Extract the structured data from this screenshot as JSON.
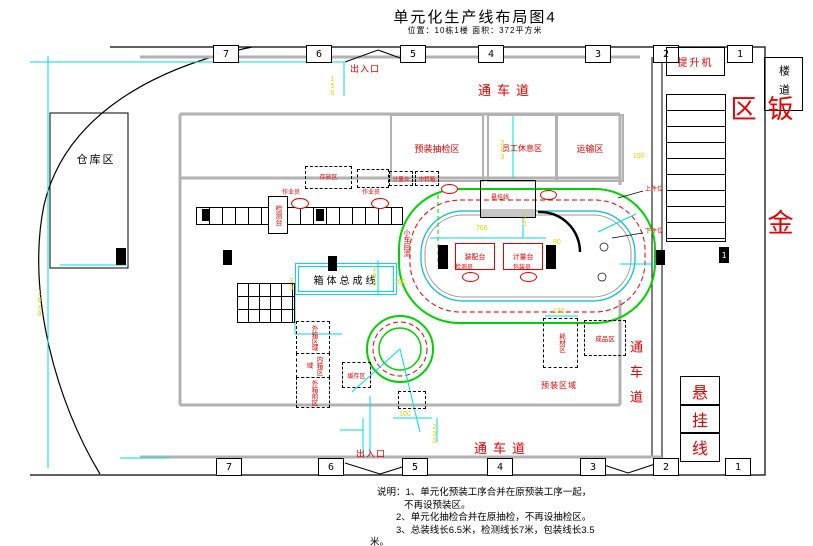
{
  "title": {
    "main": "单元化生产线布局图4",
    "subtitle": "位置：10栋1楼  面积：372平方米"
  },
  "grid": {
    "top": [
      "7",
      "6",
      "5",
      "4",
      "3",
      "2",
      "1"
    ],
    "bottom": [
      "7",
      "6",
      "5",
      "4",
      "3",
      "2",
      "1"
    ]
  },
  "corridors": {
    "top": "通车道",
    "bottom": "通车道",
    "right": "通车道"
  },
  "entrances": {
    "top": "出入口",
    "bottom": "出入口"
  },
  "zones": {
    "warehouse": "仓库区",
    "lift": "提升机",
    "stairwell": "楼道",
    "sheet_metal": "钣金区",
    "hanging": {
      "c0": "悬",
      "c1": "挂",
      "c2": "线"
    },
    "preassembly_inspection": "预装抽检区",
    "staff_rest": "员工休息区",
    "transport": "运输区",
    "preassembly_area": "预装区域",
    "outer_carton": "外箱区域",
    "inner_carton": "内箱区域",
    "outer_carton_front": "外箱前区",
    "buffer": "缓存区",
    "consumables": "耗材区",
    "finished_goods": "成品区",
    "box_assembly_line": "箱体总成线"
  },
  "stations": {
    "assembly": "装配台",
    "metering": "计量台",
    "test": "检测台",
    "storage": "存放区",
    "metering_small": "计量台",
    "transfer_box": "中转箱",
    "machine_label": "悬挂线",
    "load": "上件位",
    "unload": "下件位",
    "trolley_return": "小车回流",
    "column_label": "1"
  },
  "people": {
    "operator_a": "作业员",
    "operator_b": "作业员",
    "inspector": "检测员",
    "packer": "包装员"
  },
  "dims": [
    "766",
    "50",
    "80",
    "150",
    "150",
    "130",
    "186",
    "100",
    "30",
    "100",
    "230",
    "18x9",
    "283"
  ],
  "notes": [
    "说明：1、单元化预装工序合并在原预装工序一起，",
    "不再设预装区。",
    "2、单元化抽检合并在原抽检，不再设抽检区。",
    "3、总装线长6.5米，检测线长7米，包装线长3.5",
    "米。"
  ],
  "colors": {
    "red": "#e00000",
    "green": "#00d000",
    "cyan": "#00dcdc",
    "yellow": "#e0d000",
    "wall_gray": "#b2b2b2"
  }
}
